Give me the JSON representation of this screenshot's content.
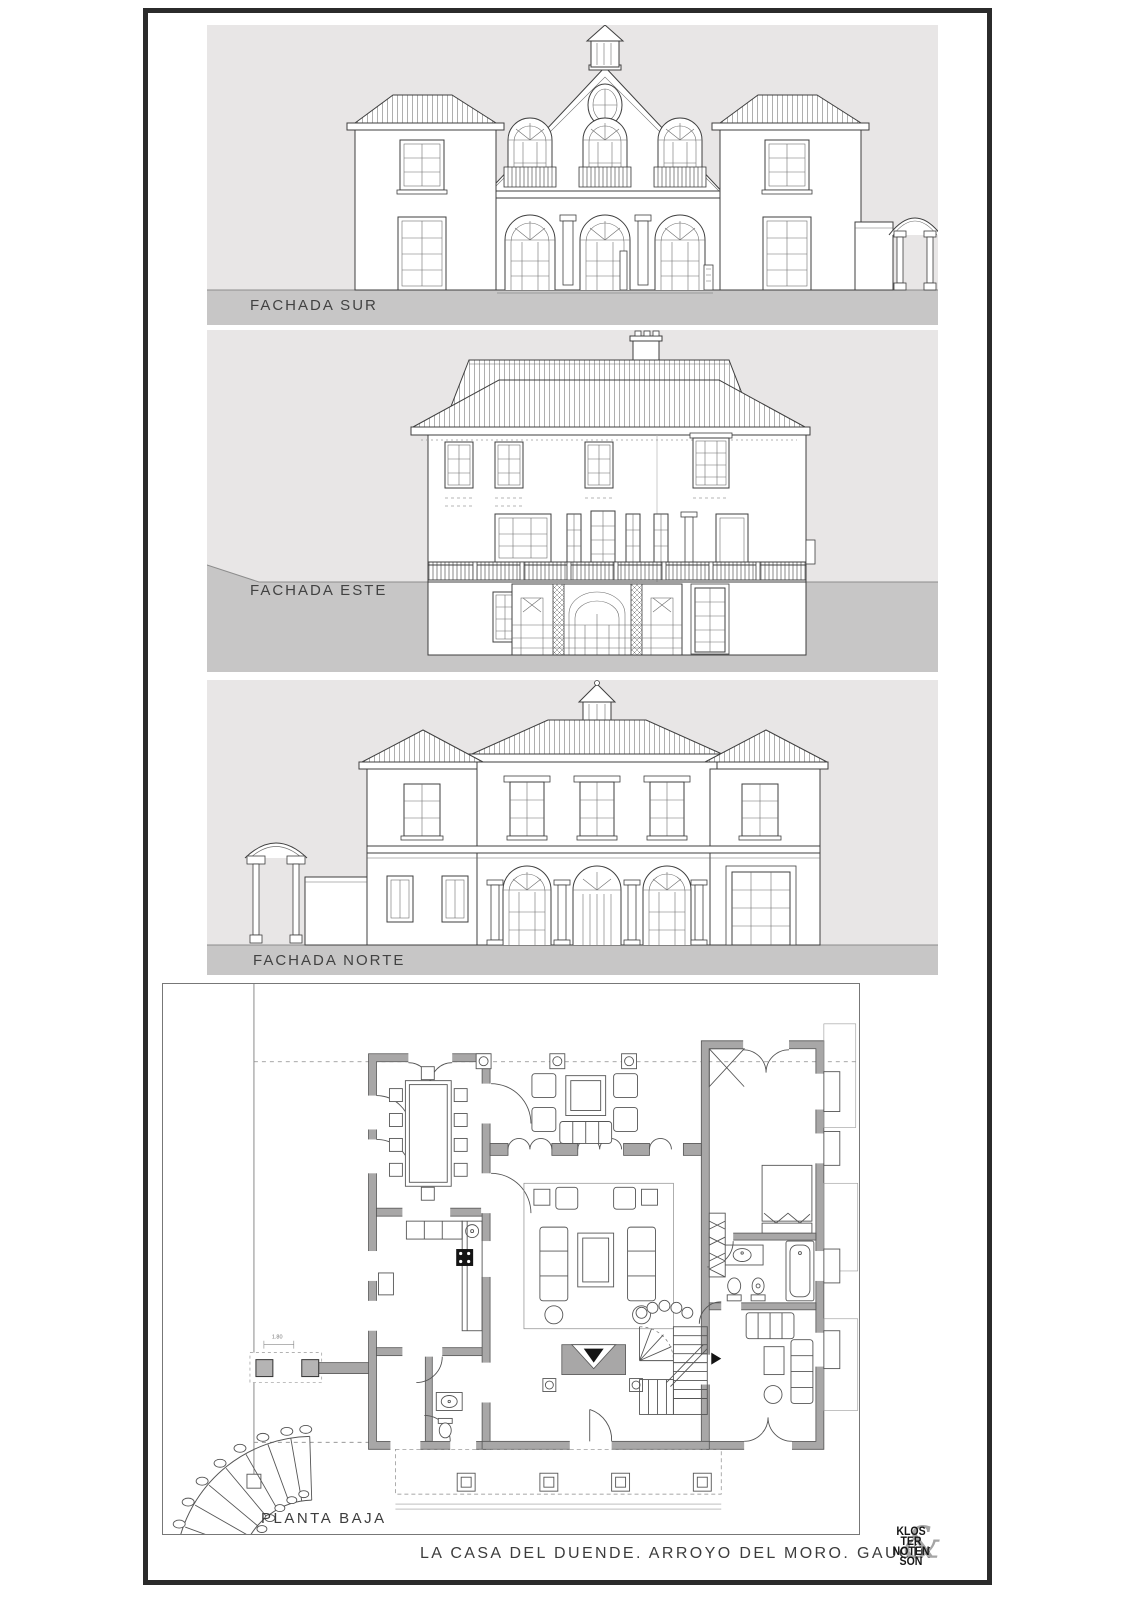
{
  "page": {
    "background": "#ffffff",
    "frame_color": "#2b2b2b"
  },
  "colors": {
    "panel_background": "#e8e6e6",
    "ground_band": "#c7c6c6",
    "drawing_line": "#3f3f3f",
    "plan_wall": "#a8a7a7",
    "label_text": "#424242",
    "logo_ampersand": "#a5a5a5"
  },
  "elevations": [
    {
      "id": "sur",
      "label": "FACHADA SUR"
    },
    {
      "id": "este",
      "label": "FACHADA ESTE"
    },
    {
      "id": "norte",
      "label": "FACHADA NORTE"
    }
  ],
  "plan": {
    "label": "PLANTA BAJA",
    "dimension_label": "1.80"
  },
  "footer": {
    "title": "LA CASA DEL DUENDE. ARROYO DEL MORO. GAUCÍN"
  },
  "logo": {
    "lines": [
      "KLOS",
      "TER",
      "NOTEN",
      "SON"
    ],
    "ampersand": "&"
  }
}
